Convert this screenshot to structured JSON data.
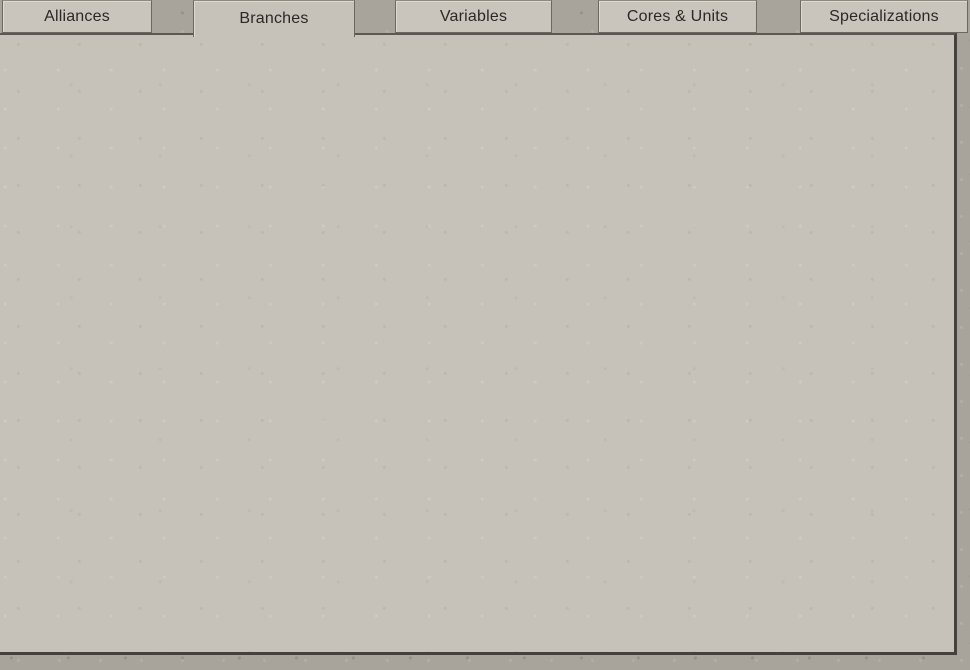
{
  "tabs": [
    {
      "label": "Alliances",
      "selected": false
    },
    {
      "label": "Branches",
      "selected": true
    },
    {
      "label": "Variables",
      "selected": false
    },
    {
      "label": "Cores & Units",
      "selected": false
    },
    {
      "label": "Specializations",
      "selected": false
    }
  ],
  "sidebar": {
    "items": [
      {
        "name": "Donbass",
        "id_label": "(ID 0)",
        "selected": false,
        "checked": false
      },
      {
        "name": "Rumyantsev",
        "id_label": "(ID 1)",
        "selected": false,
        "checked": true
      },
      {
        "name": "DEFEAT",
        "id_label": "(ID 12)",
        "selected": false,
        "checked": true
      },
      {
        "name": "VICTORY",
        "id_label": "(ID 13)",
        "selected": false,
        "checked": true
      },
      {
        "name": "Smolensk_43",
        "id_label": "(ID 14)",
        "selected": false,
        "checked": true
      },
      {
        "name": "Zhitomir",
        "id_label": "(ID 15)",
        "selected": false,
        "checked": true
      },
      {
        "name": "Novgorod",
        "id_label": "(ID 16)",
        "selected": true,
        "checked": true
      },
      {
        "name": "Vyazma_44",
        "id_label": "(ID 17)",
        "selected": false,
        "checked": true
      }
    ],
    "delete_glyph": "✖"
  },
  "toolbar": {
    "add_event_label": "Add event",
    "selected_branch_label": "NOVGOROD",
    "add_scenario_label": "Add scenario",
    "delete_glyph": "✖"
  },
  "event_row": {
    "items": [
      "DEFEAT",
      "Anzio",
      "Anzio",
      "Anzio",
      "Vyazma_44"
    ],
    "highlight_color": "#e31313"
  },
  "form": {
    "name_label": "Name",
    "name_value": "Novgorod",
    "date_label": "date",
    "date": {
      "day": "16",
      "month": "1",
      "year": "1944"
    }
  },
  "footer": {
    "start_date_label": "Start date",
    "start_date": {
      "day": "1",
      "month": "7",
      "year": "1943"
    },
    "end_date_label": "End date",
    "end_date": {
      "day": "1",
      "month": "1",
      "year": "1946"
    }
  },
  "scrollbar": {
    "up_glyph": "▲",
    "down_glyph": "▼"
  },
  "colors": {
    "panel_bg": "#c6c2ba",
    "outer_bg": "#a8a49c",
    "button_bg": "#cbc7bf",
    "delete_x": "#8c453d",
    "highlight_border": "#e31313",
    "text": "#2b2925"
  }
}
